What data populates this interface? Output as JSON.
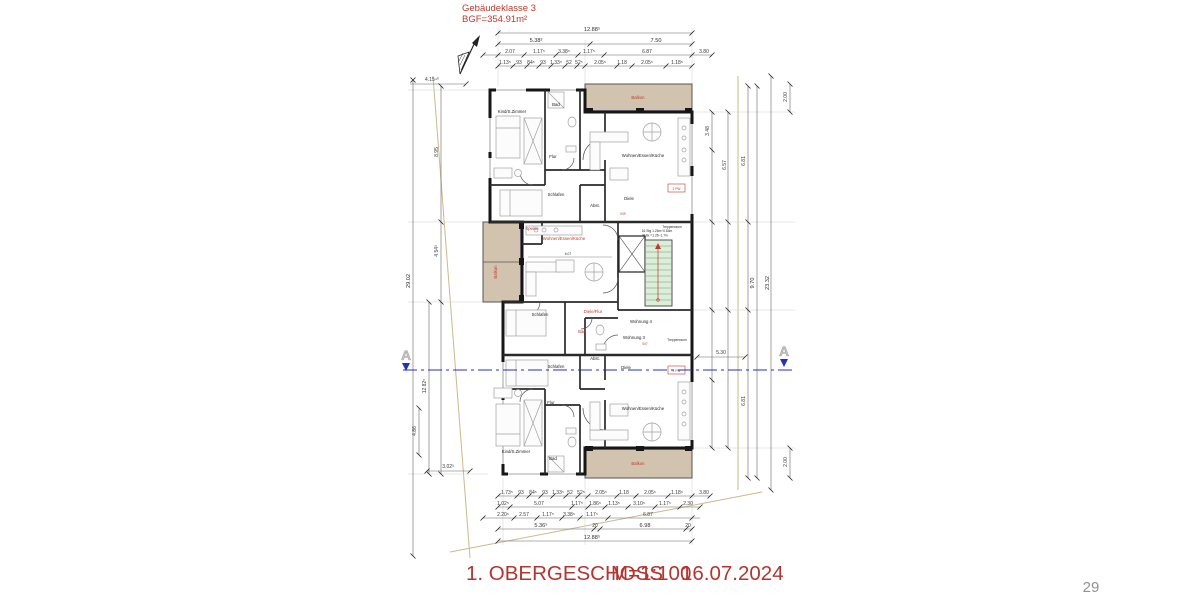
{
  "header": {
    "line1": "Gebäudeklasse 3",
    "line2": "BGF=354.91m²"
  },
  "footer": {
    "title": "1. OBERGESCHOSS",
    "scale": "M=1:100",
    "date": "16.07.2024",
    "page": "29"
  },
  "section": {
    "label_left": "A",
    "label_right": "A"
  },
  "rooms": {
    "balkon_top": "Balkon",
    "balkon_left": "Balkon",
    "balkon_bottom": "Balkon",
    "kind_top": "Kind/S.Zimmer",
    "bad_top": "Bad",
    "flur_top": "Flur",
    "wek_top": "Wohnen/Essen/Küche",
    "schlafen_top": "Schlafen",
    "abst_top": "Abst.",
    "diele_top": "Diele",
    "treppenraum_top": "Treppenraum",
    "speise": "Speise",
    "wek_mid": "Wohnen/Essen/Küche",
    "schlafen_mid": "Schlafen",
    "diele_flur_mid": "Diele/Flur",
    "bad_mid": "Bad",
    "wohnung4": "Wohnung 4",
    "wohnung3": "Wohnung 3",
    "treppenraum_bottom": "Treppenraum",
    "schlafen_bottom": "Schlafen",
    "abst_bottom": "Abst.",
    "diele_bottom": "Diele",
    "flur_bottom": "Flur",
    "kind_bottom": "Kind/S.Zimmer",
    "bad_bottom": "Bad",
    "wek_bottom": "Wohnen/Essen/Küche"
  },
  "tags": {
    "pw_top": "2 PW",
    "pw_bottom": "2 PW",
    "door_top": "009",
    "door_bottom": "007",
    "stair_note1": "16 Stg 1.26m÷0.84m",
    "stair_note2": "St.Br.=1.26–1.7m",
    "wek_inner_dim": "6.07"
  },
  "dims": {
    "top_r1": "12.88⁵",
    "top_r2": [
      "5.38³",
      "7.50"
    ],
    "top_r3": [
      "2.07",
      "1.17⁵",
      "3.38⁵",
      "1.17⁵",
      "6.87",
      "3.80"
    ],
    "top_r4": [
      "1.13⁵",
      "93",
      "84⁵",
      "93",
      "1.33⁵",
      "52",
      "52⁵",
      "2.05⁵",
      "1.18",
      "2.05⁵",
      "1.18⁵"
    ],
    "bot_r1": [
      "1.73⁵",
      "93",
      "84⁵",
      "93",
      "1.33⁵",
      "52",
      "52⁵",
      "2.05⁵",
      "1.18",
      "2.05⁵",
      "1.18⁵",
      "3.80"
    ],
    "bot_r2": [
      "1.02⁵",
      "5.07",
      "1.17⁵",
      "1.86⁵",
      "1.13⁵",
      "3.10⁵",
      "1.17⁵",
      "2.30"
    ],
    "bot_r3": [
      "2.20⁵",
      "2.57",
      "1.17⁵",
      "3.38⁵",
      "1.17⁵",
      "6.87"
    ],
    "bot_r4": [
      "5.36⁵",
      "20",
      "6.98",
      "20"
    ],
    "bot_r5": "12.88⁵",
    "left": [
      "4.15⁴⁰",
      "8.95",
      "4.54³",
      "12.82⁵",
      "4.86",
      "29.02",
      "3.02³"
    ],
    "right": [
      "2.00",
      "3.48",
      "6.57",
      "6.81",
      "9.70",
      "23.32",
      "5.30",
      "6.81",
      "2.00"
    ]
  },
  "colors": {
    "red_text": "#c0392b",
    "balcony_fill": "#d2c3ae",
    "stair_fill": "#dcedd9",
    "section_line": "#2233bb",
    "boundary_line": "#cdb98b"
  }
}
